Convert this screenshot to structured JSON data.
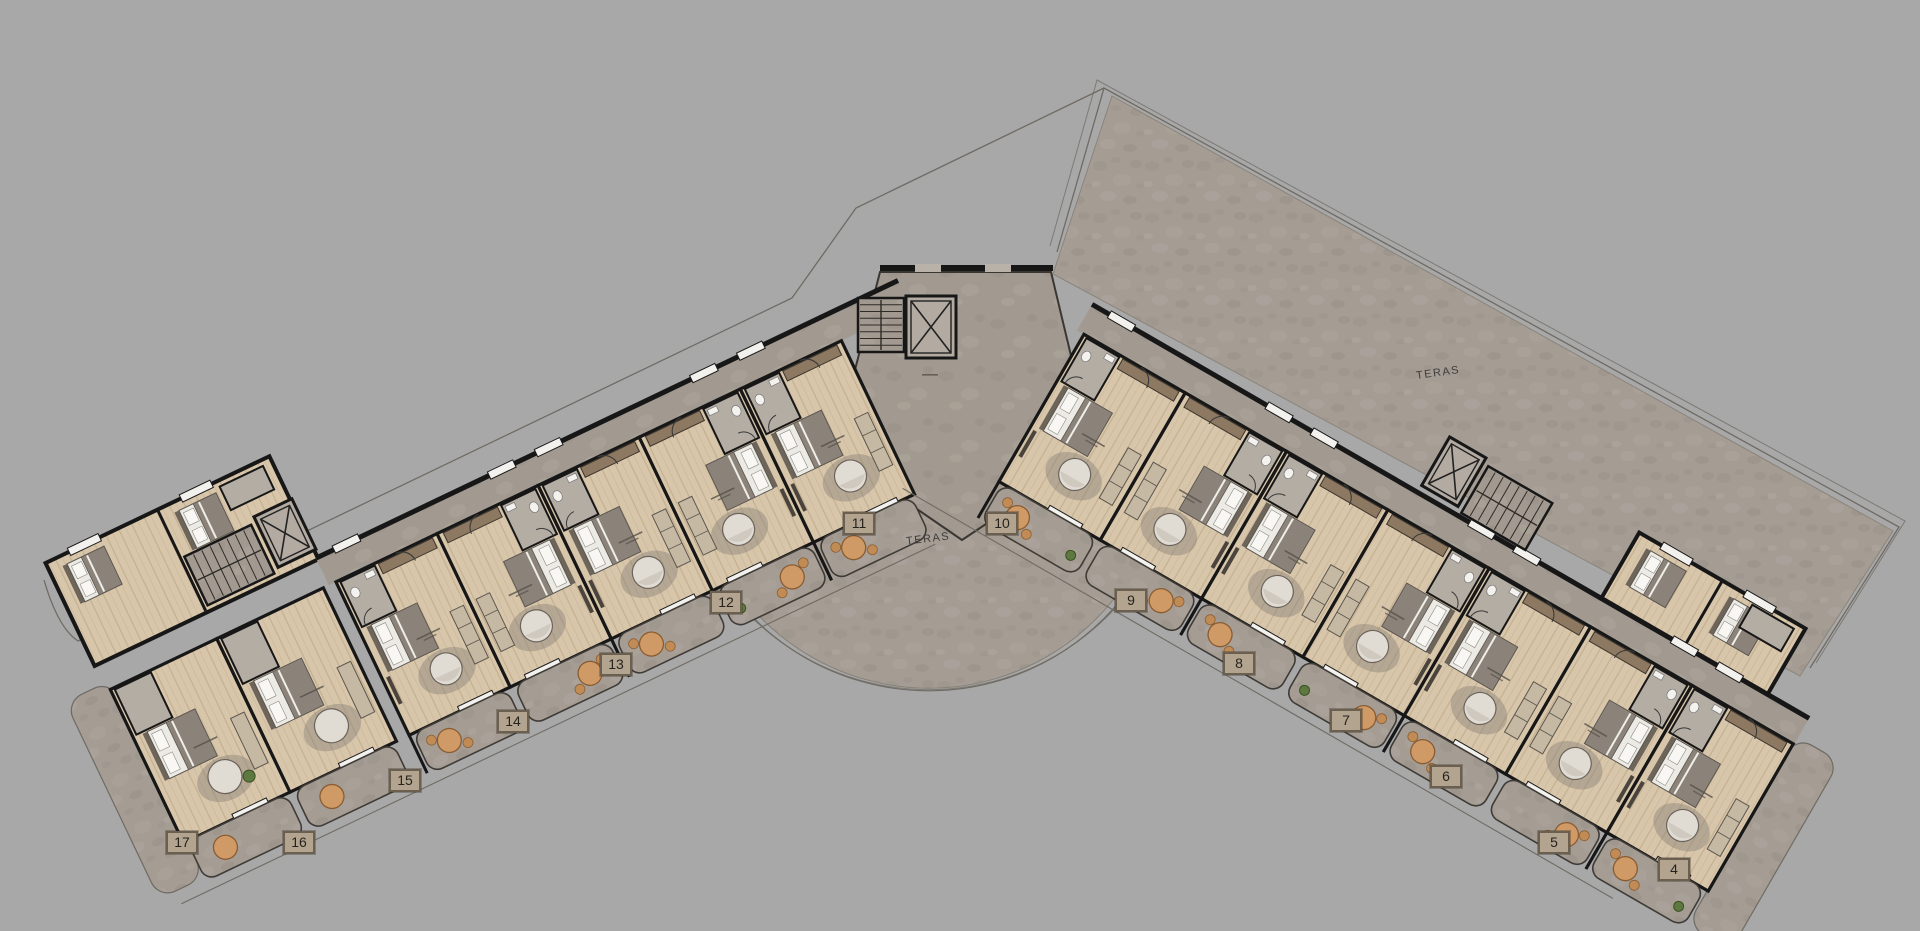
{
  "terrace_labels": [
    {
      "text": "TERAS",
      "x": 928,
      "y": 541,
      "rot": -7
    },
    {
      "text": "TERAS",
      "x": 1438,
      "y": 375,
      "rot": -8
    }
  ],
  "unit_badges": [
    {
      "label": "17",
      "x": 182,
      "y": 843
    },
    {
      "label": "16",
      "x": 299,
      "y": 843
    },
    {
      "label": "15",
      "x": 405,
      "y": 781
    },
    {
      "label": "14",
      "x": 513,
      "y": 722
    },
    {
      "label": "13",
      "x": 616,
      "y": 665
    },
    {
      "label": "12",
      "x": 726,
      "y": 603
    },
    {
      "label": "11",
      "x": 859,
      "y": 524
    },
    {
      "label": "10",
      "x": 1002,
      "y": 524
    },
    {
      "label": "9",
      "x": 1131,
      "y": 601
    },
    {
      "label": "8",
      "x": 1239,
      "y": 664
    },
    {
      "label": "7",
      "x": 1346,
      "y": 721
    },
    {
      "label": "6",
      "x": 1446,
      "y": 777
    },
    {
      "label": "5",
      "x": 1554,
      "y": 843
    },
    {
      "label": "4",
      "x": 1674,
      "y": 870
    }
  ],
  "colors": {
    "background": "#a8a8a8",
    "terrace": "#a59d94",
    "wall": "#171717",
    "wood_floor": "#d8c6ab",
    "wood_line": "#c4b091",
    "corridor": "#a29a90",
    "bath": "#b4ada4",
    "bed_sheet": "#eceae5",
    "blanket": "#8b8379",
    "pillow": "#f8f7f4",
    "sofa": "#c6b9a3",
    "closet": "#8d7861",
    "round_table": "#cf9a66",
    "seating": "#e0dbd3",
    "rug": "#8a8175",
    "plant": "#5d7840",
    "badge_fill": "#b3a48f",
    "badge_border": "#6b5f4f",
    "outline": "#6f6b64"
  }
}
